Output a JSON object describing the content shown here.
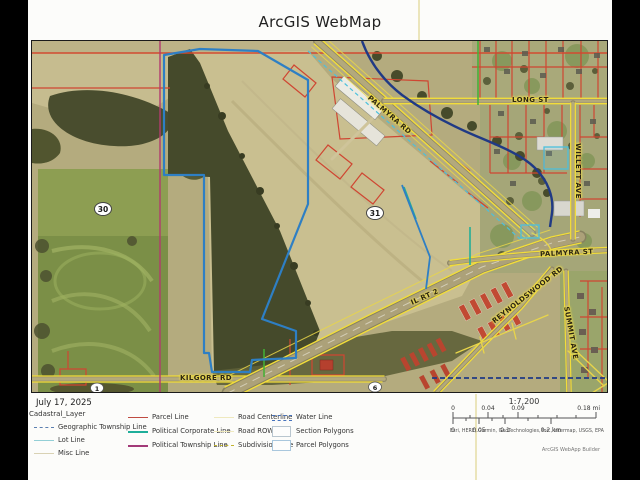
{
  "title": "ArcGIS WebMap",
  "map_date": "July 17, 2025",
  "map": {
    "roads": {
      "palmyra_rd": "PALMYRA RD",
      "long_st": "LONG ST",
      "willett_ave": "WILLETT AVE",
      "palmyra_st": "PALMYRA ST",
      "il_rt_2": "IL RT 2",
      "reynoldswood_rd": "REYNOLDSWOOD RD",
      "summit_ave": "SUMMIT AVE",
      "kilgore_rd": "KILGORE RD"
    },
    "markers": [
      {
        "label": "30"
      },
      {
        "label": "31"
      },
      {
        "label": "1"
      },
      {
        "label": "6"
      }
    ]
  },
  "legend": {
    "heading": "Cadastral_Layer",
    "items": [
      {
        "label": "Geographic Township Line"
      },
      {
        "label": "Lot Line"
      },
      {
        "label": "Misc Line"
      },
      {
        "label": "Parcel Line"
      },
      {
        "label": "Political Corporate Line"
      },
      {
        "label": "Political Township Line"
      },
      {
        "label": "Road Centerline"
      },
      {
        "label": "Road ROW"
      },
      {
        "label": "Subdivision Line"
      },
      {
        "label": "Water Line"
      },
      {
        "label": "Section Polygons"
      },
      {
        "label": "Parcel Polygons"
      }
    ]
  },
  "scale": {
    "ratio": "1:7,200",
    "mi": [
      "0",
      "0.04",
      "0.09",
      "0.18 mi"
    ],
    "km": [
      "0",
      "0.05",
      "0.1",
      "0.2 km"
    ]
  },
  "attribution": {
    "sources": "Esri, HERE, Garmin, GeoTechnologies, Inc., Intermap, USGS, EPA",
    "app": "ArcGIS WebApp Builder"
  },
  "colors": {
    "parcel_line": "#bf4b41",
    "political_corporate_line": "#1fae9a",
    "political_township_line": "#a23a78",
    "water_line": "#203a85",
    "road_yellow": "#f2dd3a",
    "parcel_polygon_blue": "#2e7fc4"
  }
}
